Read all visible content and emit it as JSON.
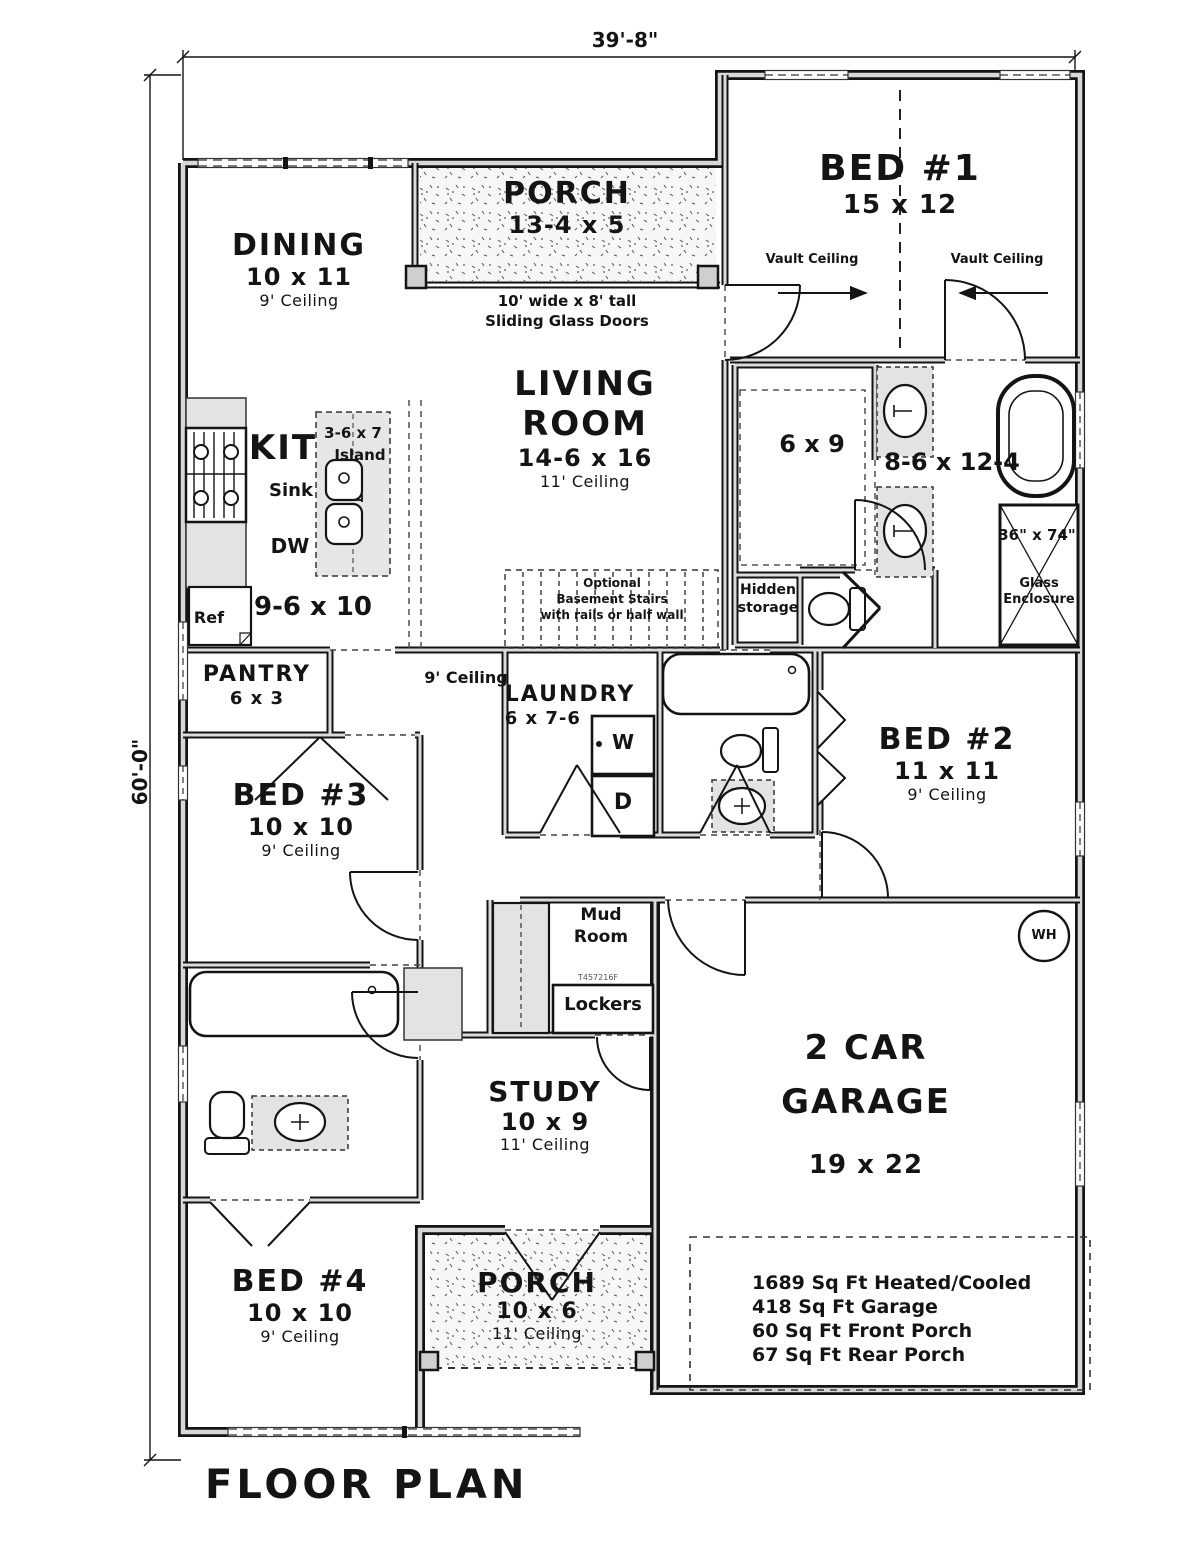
{
  "meta": {
    "plan_title": "FLOOR PLAN",
    "width_dim": "39'-8\"",
    "height_dim": "60'-0\""
  },
  "rooms": {
    "porch_front": {
      "name": "PORCH",
      "size": "13-4 x 5"
    },
    "bed1": {
      "name": "BED #1",
      "size": "15 x 12"
    },
    "dining": {
      "name": "DINING",
      "size": "10 x 11",
      "ceiling": "9' Ceiling"
    },
    "living": {
      "name_line1": "LIVING",
      "name_line2": "ROOM",
      "size": "14-6 x 16",
      "ceiling": "11' Ceiling"
    },
    "kitchen": {
      "name": "KIT",
      "size": "9-6 x 10"
    },
    "island": {
      "size": "3-6 x 7",
      "label": "Island"
    },
    "pantry": {
      "name": "PANTRY",
      "size": "6 x 3"
    },
    "master_closet": {
      "size": "6 x 9"
    },
    "master_bath": {
      "size": "8-6 x 12-4"
    },
    "shower": {
      "size": "36\" x 74\"",
      "label_line1": "Glass",
      "label_line2": "Enclosure"
    },
    "hidden_storage": {
      "label_line1": "Hidden",
      "label_line2": "storage"
    },
    "laundry": {
      "name": "LAUNDRY",
      "size": "6 x 7-6"
    },
    "bed2": {
      "name": "BED #2",
      "size": "11 x 11",
      "ceiling": "9' Ceiling"
    },
    "bed3": {
      "name": "BED #3",
      "size": "10 x 10",
      "ceiling": "9' Ceiling"
    },
    "mud_room": {
      "name_line1": "Mud",
      "name_line2": "Room"
    },
    "lockers": {
      "label": "Lockers"
    },
    "study": {
      "name": "STUDY",
      "size": "10 x 9",
      "ceiling": "11' Ceiling"
    },
    "garage": {
      "name_line1": "2 CAR",
      "name_line2": "GARAGE",
      "size": "19 x 22"
    },
    "bed4": {
      "name": "BED #4",
      "size": "10 x 10",
      "ceiling": "9' Ceiling"
    },
    "porch_rear": {
      "name": "PORCH",
      "size": "10 x 6",
      "ceiling": "11' Ceiling"
    }
  },
  "annotations": {
    "hall_ceiling": "9' Ceiling",
    "vault_ceiling_left": "Vault Ceiling",
    "vault_ceiling_right": "Vault Ceiling",
    "sliding_doors_line1": "10' wide x 8' tall",
    "sliding_doors_line2": "Sliding Glass Doors",
    "stairs_line1": "Optional",
    "stairs_line2": "Basement Stairs",
    "stairs_line3": "with rails or half wall",
    "sink": "Sink",
    "dishwasher": "DW",
    "refrigerator": "Ref",
    "washer": "W",
    "dryer": "D",
    "water_heater": "WH",
    "plan_code": "T457216F"
  },
  "area_summary": {
    "lines": [
      "1689 Sq Ft Heated/Cooled",
      "418 Sq Ft Garage",
      "60 Sq Ft Front Porch",
      "67 Sq Ft Rear Porch"
    ]
  }
}
